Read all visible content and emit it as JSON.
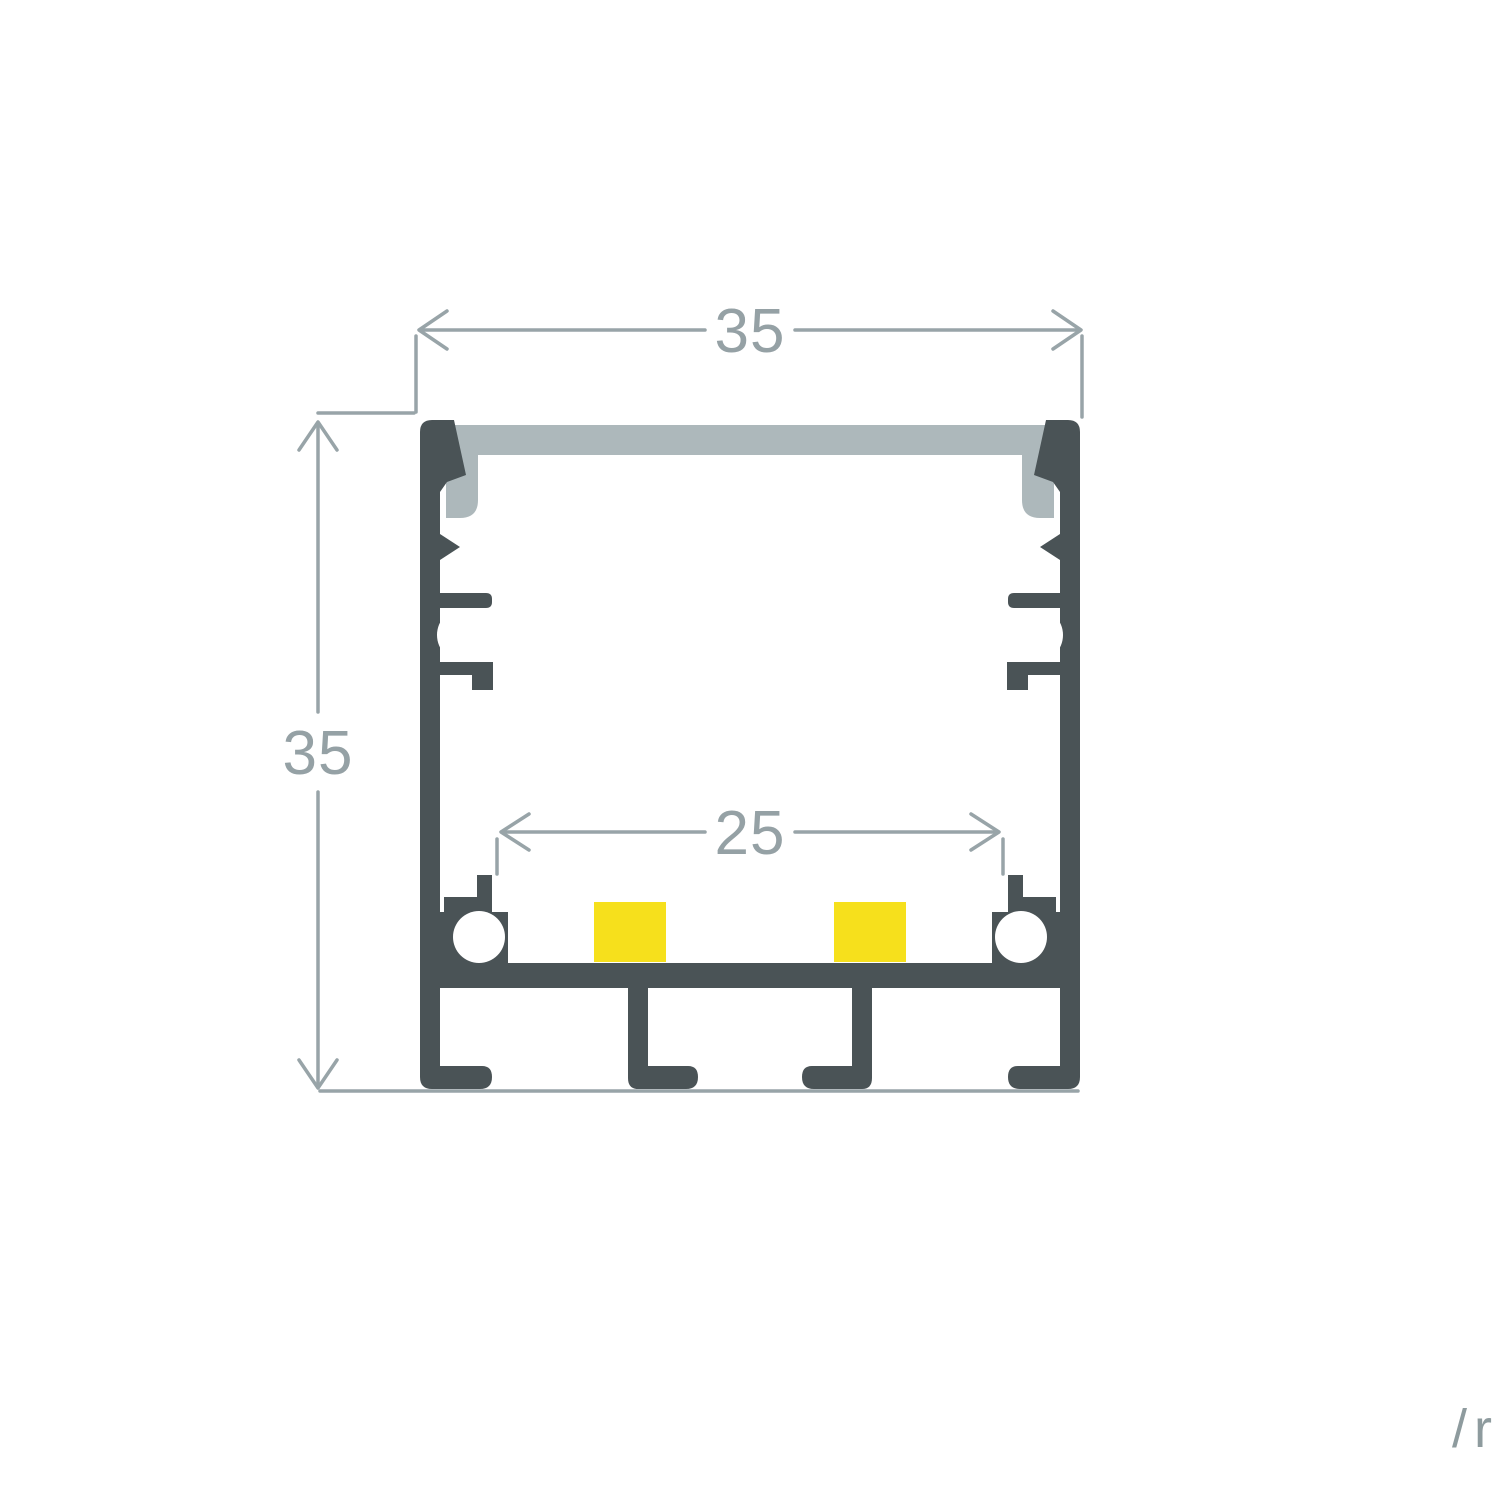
{
  "document": {
    "title": "LED aluminium profile cross-section technical drawing",
    "background": "#ffffff"
  },
  "drawing": {
    "outer_width_label": "35",
    "outer_height_label": "35",
    "inner_width_label": "25"
  },
  "watermark": {
    "text": "/r"
  },
  "colors": {
    "profile_body": "#4a5356",
    "diffuser": "#adb8bb",
    "led_strip": "#f6e01c",
    "screw_hole": "#ffffff",
    "dimension_lines": "#98a4a8",
    "dimension_text": "#95a1a5",
    "watermark_text": "#8e9b9e"
  }
}
